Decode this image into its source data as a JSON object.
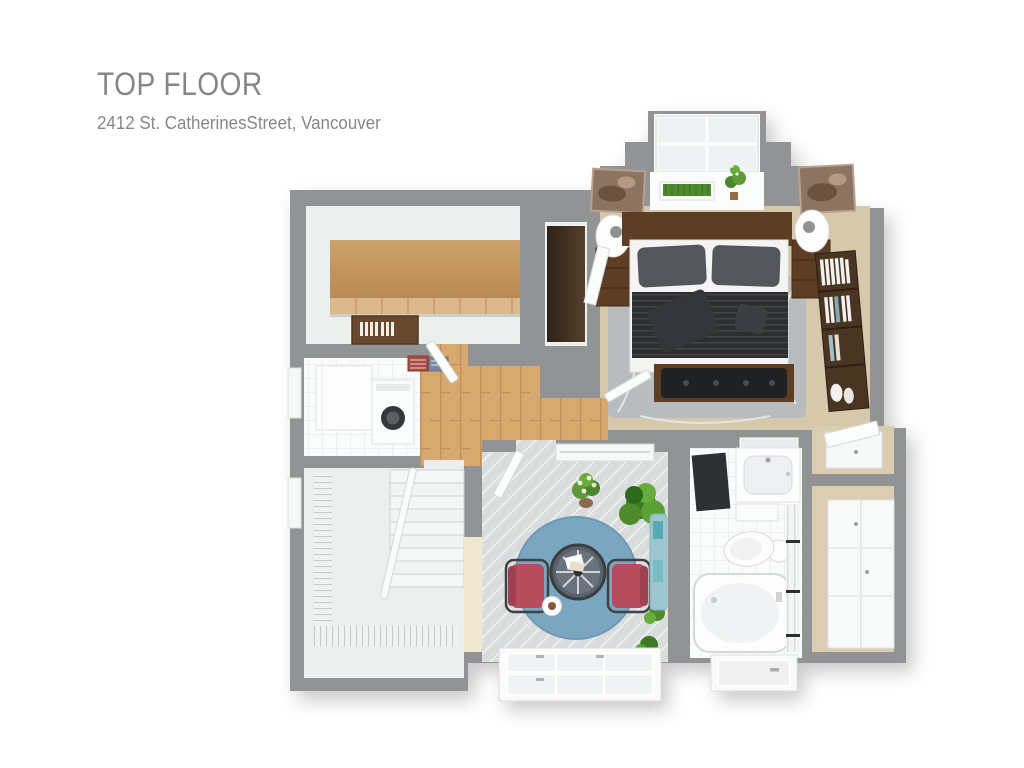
{
  "header": {
    "title": "TOP FLOOR",
    "address": "2412 St. CatherinesStreet, Vancouver"
  },
  "palette": {
    "text_gray": "#868686",
    "wall": "#919395",
    "floor_light": "#edefef",
    "carpet": "#d5c8ab",
    "carpet_right": "#dacdb2",
    "wood_floor": "#d8a96e",
    "wood_shelf_a": "#cda26b",
    "wood_shelf_b": "#b98a52",
    "tile_white": "#fafbfb",
    "patio_floor": "#d9dbdd",
    "rug_gray": "#b9bcbf",
    "rug_blue": "#7aa7bf",
    "chair_red": "#b54d5f",
    "duvet": "#2c2e30",
    "pillow_gray": "#53565a",
    "walnut": "#5d3d24",
    "walnut_dark": "#3a2a1c",
    "leather": "#1f2123",
    "plant_green": "#4d8b2f",
    "teal": "#9cc7cf",
    "cream": "#efe8d0"
  },
  "floor_plan": {
    "type": "3d-floor-plan-rendering",
    "floor_label": "Top Floor",
    "rooms": [
      {
        "name": "bedroom",
        "floor_finish": "beige carpet",
        "furniture": [
          "double-bed",
          "wood-headboard",
          "striped-dark-duvet",
          "gray-pillows",
          "throw-pillow",
          "leather-foot-bench",
          "gray-area-rug",
          "nightstand-left",
          "nightstand-right",
          "table-lamp-left",
          "table-lamp-right",
          "wall-art-left",
          "wall-art-right",
          "bookshelf-with-books",
          "dormer-window-bay",
          "grass-planter-box",
          "potted-plant"
        ]
      },
      {
        "name": "storage-closet",
        "floor_finish": "light floor",
        "furniture": [
          "long-wood-shelf",
          "wood-storage-chest"
        ]
      },
      {
        "name": "wardrobe-nook",
        "floor_finish": "light floor",
        "furniture": [
          "dark-wardrobe"
        ]
      },
      {
        "name": "laundry",
        "floor_finish": "white tile",
        "furniture": [
          "white-counter",
          "washing-machine",
          "left-wall-window",
          "shelf-decor-red",
          "shelf-decor-blue"
        ]
      },
      {
        "name": "hallway",
        "floor_finish": "oak hardwood",
        "furniture": [
          "door-to-closet",
          "door-to-bedroom",
          "door-to-patio"
        ]
      },
      {
        "name": "staircase",
        "floor_finish": "light floor",
        "furniture": [
          "stairs-down",
          "banister",
          "railing-balusters",
          "left-wall-window"
        ]
      },
      {
        "name": "patio-lounge",
        "floor_finish": "grey herringbone tile",
        "furniture": [
          "round-blue-rug",
          "round-bistro-table",
          "red-armchair-left",
          "red-armchair-right",
          "white-side-table",
          "flower-bouquet-pot",
          "large-shrub",
          "small-plant-1",
          "small-plant-2",
          "teal-heater-bench",
          "white-railing-ledge",
          "bottom-window-bay",
          "cream-panel"
        ]
      },
      {
        "name": "bathroom",
        "floor_finish": "white tile",
        "furniture": [
          "vanity-sink",
          "mirror",
          "dark-bath-mat",
          "low-cabinet",
          "toilet",
          "bathtub",
          "shower-screen",
          "exterior-door"
        ]
      },
      {
        "name": "closet-hall",
        "floor_finish": "beige carpet",
        "furniture": [
          "tilted-closet-door",
          "upper-cabinet",
          "tall-white-wardrobe"
        ]
      }
    ]
  }
}
